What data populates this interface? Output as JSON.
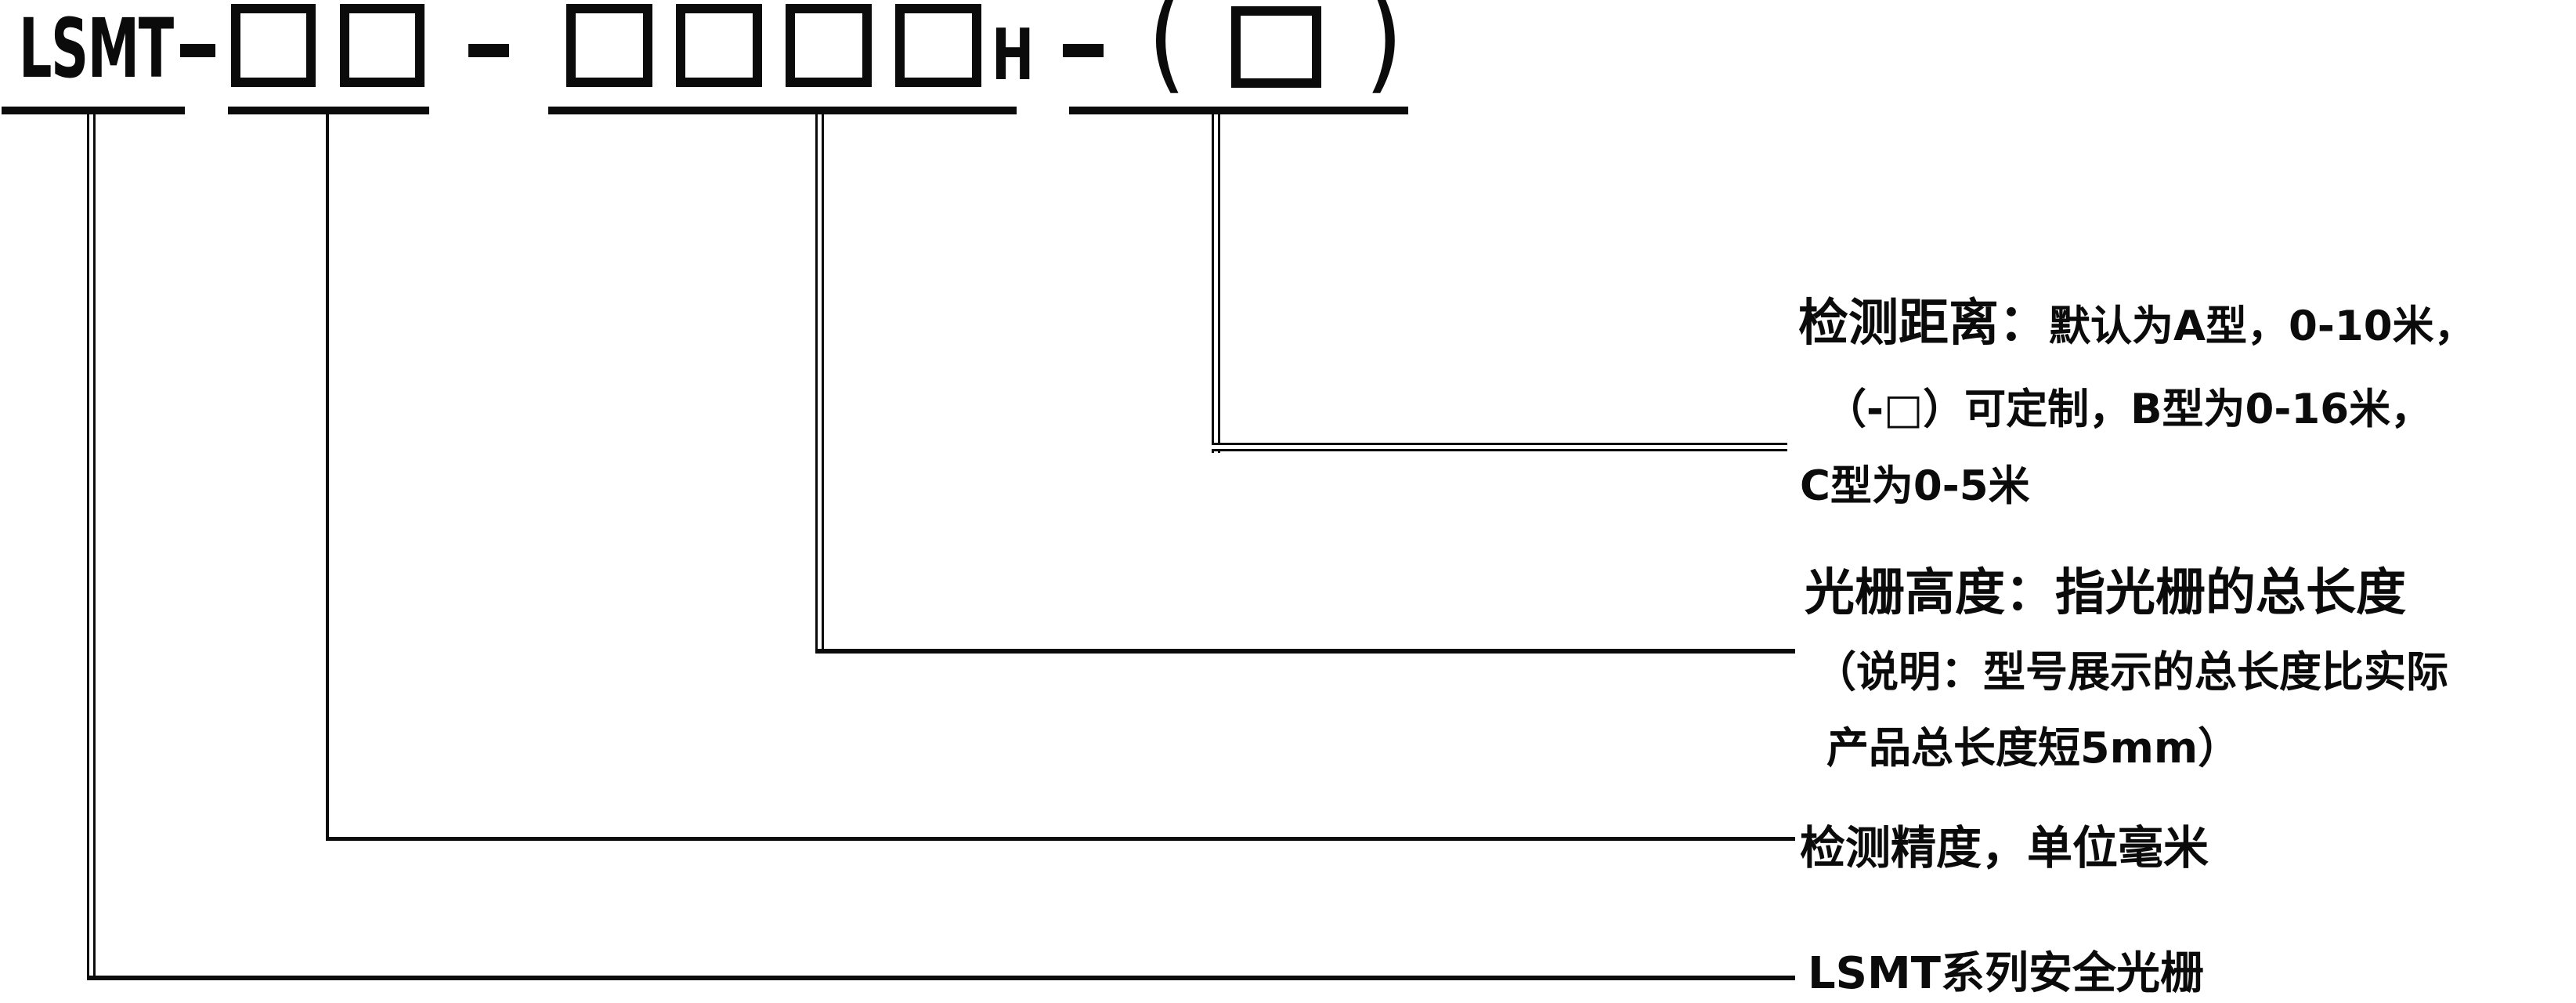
{
  "page": {
    "background": "#ffffff",
    "ink": "#0b0b0b"
  },
  "model_code": {
    "series": "LSMT",
    "separator": "-",
    "group1_box_count": 2,
    "group2_box_count": 4,
    "group2_suffix": "H",
    "open_paren": "(",
    "close_paren": ")",
    "group3_box_count": 1
  },
  "callouts": {
    "distance": {
      "title": "检测距离：",
      "line1": "默认为A型，0-10米，",
      "line2": "（-□）可定制，B型为0-16米，",
      "line3": "C型为0-5米"
    },
    "height": {
      "title": "光栅高度：",
      "line1": "指光栅的总长度",
      "line2": "（说明：型号展示的总长度比实际",
      "line3": "产品总长度短5mm）"
    },
    "precision": {
      "text": "检测精度，单位毫米"
    },
    "series": {
      "text": "LSMT系列安全光栅"
    }
  }
}
